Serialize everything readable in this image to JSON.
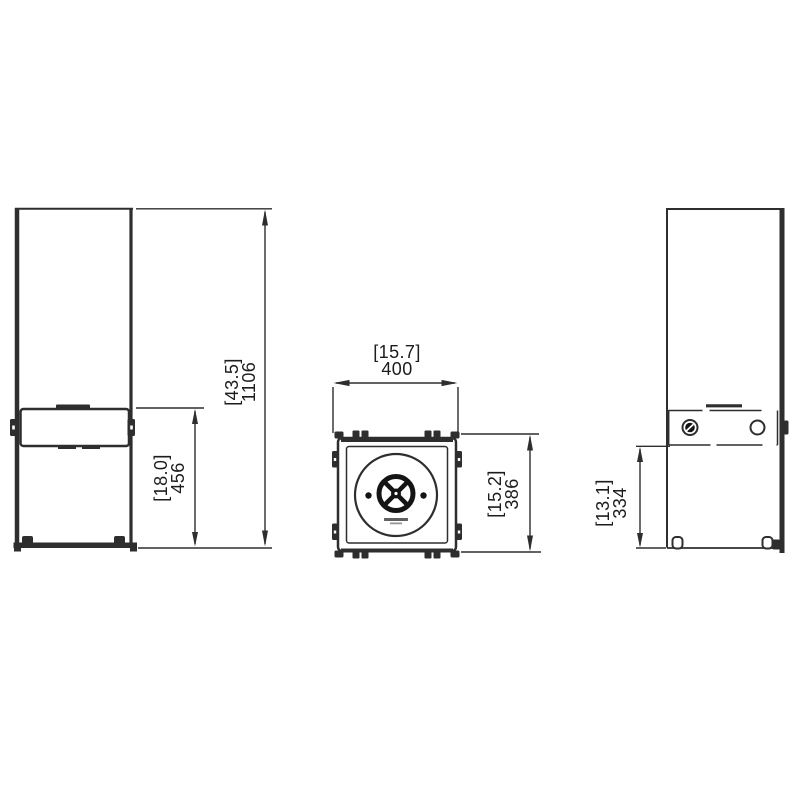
{
  "colors": {
    "background": "#ffffff",
    "line": "#2e2e2e",
    "ink": "#141414",
    "text": "#1c1c1c"
  },
  "dimensions": {
    "overall_height": {
      "inches": "[43.5]",
      "mm": "1106"
    },
    "front_panel_height": {
      "inches": "[18.0]",
      "mm": "456"
    },
    "width": {
      "inches": "[15.7]",
      "mm": "400"
    },
    "depth": {
      "inches": "[15.2]",
      "mm": "386"
    },
    "side_panel_height": {
      "inches": "[13.1]",
      "mm": "334"
    }
  }
}
